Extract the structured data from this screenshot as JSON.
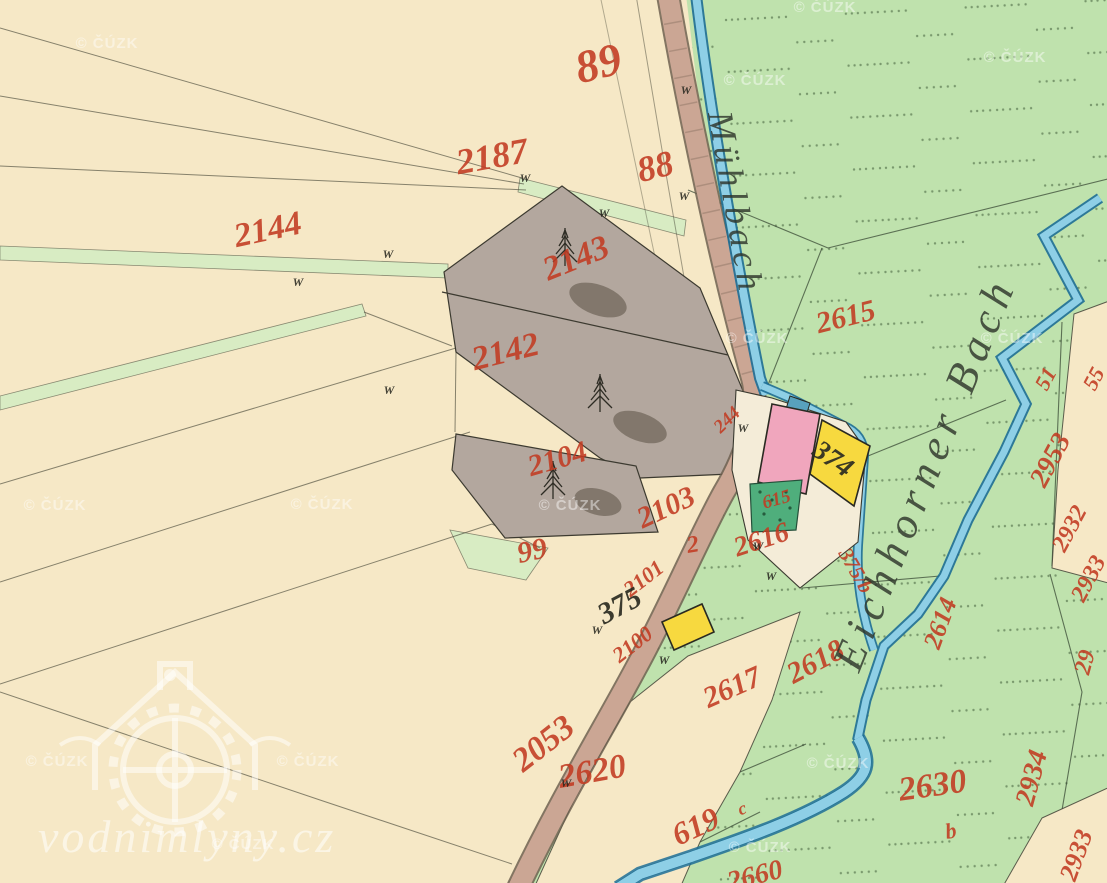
{
  "map": {
    "stream_labels": [
      {
        "text": "Mühlbach",
        "x": 724,
        "y": 205,
        "rot": 80,
        "size": 36,
        "spacing": 5
      },
      {
        "text": "Eichhorner Bach",
        "x": 938,
        "y": 478,
        "rot": -68,
        "size": 44,
        "spacing": 8
      }
    ],
    "parcel_labels": [
      {
        "text": "89",
        "x": 602,
        "y": 78,
        "rot": -14,
        "size": 46,
        "ink": "red"
      },
      {
        "text": "88",
        "x": 658,
        "y": 178,
        "rot": -14,
        "size": 36,
        "ink": "red"
      },
      {
        "text": "2187",
        "x": 494,
        "y": 168,
        "rot": -10,
        "size": 36,
        "ink": "red"
      },
      {
        "text": "2144",
        "x": 270,
        "y": 240,
        "rot": -12,
        "size": 34,
        "ink": "red"
      },
      {
        "text": "2143",
        "x": 580,
        "y": 268,
        "rot": -22,
        "size": 34,
        "ink": "red"
      },
      {
        "text": "2142",
        "x": 508,
        "y": 362,
        "rot": -14,
        "size": 34,
        "ink": "red"
      },
      {
        "text": "2104",
        "x": 560,
        "y": 468,
        "rot": -16,
        "size": 30,
        "ink": "red"
      },
      {
        "text": "2103",
        "x": 670,
        "y": 516,
        "rot": -25,
        "size": 30,
        "ink": "red"
      },
      {
        "text": "2",
        "x": 694,
        "y": 552,
        "rot": -10,
        "size": 24,
        "ink": "red"
      },
      {
        "text": "99",
        "x": 534,
        "y": 560,
        "rot": -12,
        "size": 30,
        "ink": "red"
      },
      {
        "text": "2101",
        "x": 648,
        "y": 584,
        "rot": -38,
        "size": 22,
        "ink": "red"
      },
      {
        "text": "2100",
        "x": 637,
        "y": 650,
        "rot": -38,
        "size": 22,
        "ink": "red"
      },
      {
        "text": "2616",
        "x": 764,
        "y": 548,
        "rot": -18,
        "size": 28,
        "ink": "red"
      },
      {
        "text": "244",
        "x": 731,
        "y": 424,
        "rot": -44,
        "size": 19,
        "ink": "red"
      },
      {
        "text": "615",
        "x": 778,
        "y": 505,
        "rot": -16,
        "size": 19,
        "ink": "red"
      },
      {
        "text": "2615",
        "x": 848,
        "y": 326,
        "rot": -14,
        "size": 30,
        "ink": "red"
      },
      {
        "text": "375/b",
        "x": 850,
        "y": 574,
        "rot": 60,
        "size": 21,
        "ink": "red"
      },
      {
        "text": "2614",
        "x": 948,
        "y": 626,
        "rot": -70,
        "size": 26,
        "ink": "red"
      },
      {
        "text": "2617",
        "x": 736,
        "y": 696,
        "rot": -24,
        "size": 30,
        "ink": "red"
      },
      {
        "text": "2618",
        "x": 820,
        "y": 670,
        "rot": -28,
        "size": 30,
        "ink": "red"
      },
      {
        "text": "2620",
        "x": 594,
        "y": 782,
        "rot": -10,
        "size": 34,
        "ink": "red"
      },
      {
        "text": "2053",
        "x": 550,
        "y": 752,
        "rot": -38,
        "size": 34,
        "ink": "red"
      },
      {
        "text": "619",
        "x": 700,
        "y": 836,
        "rot": -25,
        "size": 32,
        "ink": "red"
      },
      {
        "text": "c",
        "x": 744,
        "y": 814,
        "rot": -20,
        "size": 18,
        "ink": "red"
      },
      {
        "text": "2660",
        "x": 757,
        "y": 884,
        "rot": -14,
        "size": 28,
        "ink": "red"
      },
      {
        "text": "2630",
        "x": 934,
        "y": 796,
        "rot": -8,
        "size": 34,
        "ink": "red"
      },
      {
        "text": "b",
        "x": 952,
        "y": 838,
        "rot": -10,
        "size": 22,
        "ink": "red"
      },
      {
        "text": "2934",
        "x": 1040,
        "y": 780,
        "rot": -75,
        "size": 28,
        "ink": "red"
      },
      {
        "text": "29",
        "x": 1092,
        "y": 664,
        "rot": -75,
        "size": 24,
        "ink": "red"
      },
      {
        "text": "2953",
        "x": 1058,
        "y": 464,
        "rot": -62,
        "size": 28,
        "ink": "red"
      },
      {
        "text": "51",
        "x": 1052,
        "y": 382,
        "rot": -62,
        "size": 22,
        "ink": "red"
      },
      {
        "text": "55",
        "x": 1100,
        "y": 382,
        "rot": -62,
        "size": 22,
        "ink": "red"
      },
      {
        "text": "2932",
        "x": 1076,
        "y": 532,
        "rot": -62,
        "size": 24,
        "ink": "red"
      },
      {
        "text": "2933",
        "x": 1095,
        "y": 582,
        "rot": -62,
        "size": 24,
        "ink": "red"
      },
      {
        "text": "2933",
        "x": 1084,
        "y": 858,
        "rot": -70,
        "size": 26,
        "ink": "red"
      },
      {
        "text": "375",
        "x": 624,
        "y": 614,
        "rot": -28,
        "size": 30,
        "ink": "black"
      },
      {
        "text": "374",
        "x": 828,
        "y": 466,
        "rot": 35,
        "size": 28,
        "ink": "black"
      }
    ],
    "boundary_marks": [
      [
        525,
        182
      ],
      [
        604,
        217
      ],
      [
        686,
        94
      ],
      [
        684,
        200
      ],
      [
        298,
        286
      ],
      [
        388,
        258
      ],
      [
        389,
        394
      ],
      [
        743,
        432
      ],
      [
        758,
        550
      ],
      [
        771,
        580
      ],
      [
        597,
        634
      ],
      [
        664,
        664
      ],
      [
        566,
        787
      ]
    ],
    "legend_colors": {
      "field_cream": "#f6e8c6",
      "meadow_green": "#bfe2ad",
      "light_strip_green": "#d8ecc3",
      "woodland_gray": "#b3a79e",
      "road_brown": "#cba694",
      "water_blue": "#8ecfe6",
      "building_masonry_pink": "#f0a6bd",
      "building_wood_yellow": "#f7d93f",
      "garden_green": "#4fae7c",
      "label_red": "#c23b22",
      "ink_black": "#2c2c22"
    }
  },
  "watermarks": {
    "cuzk_text": "© ČÚZK",
    "cuzk_positions": [
      [
        107,
        48
      ],
      [
        825,
        12
      ],
      [
        755,
        85
      ],
      [
        1015,
        62
      ],
      [
        757,
        343
      ],
      [
        1012,
        343
      ],
      [
        55,
        510
      ],
      [
        322,
        509
      ],
      [
        570,
        510
      ],
      [
        838,
        768
      ],
      [
        57,
        766
      ],
      [
        308,
        766
      ],
      [
        243,
        849
      ],
      [
        760,
        852
      ]
    ],
    "logo_text": "vodnimlyny.cz"
  }
}
